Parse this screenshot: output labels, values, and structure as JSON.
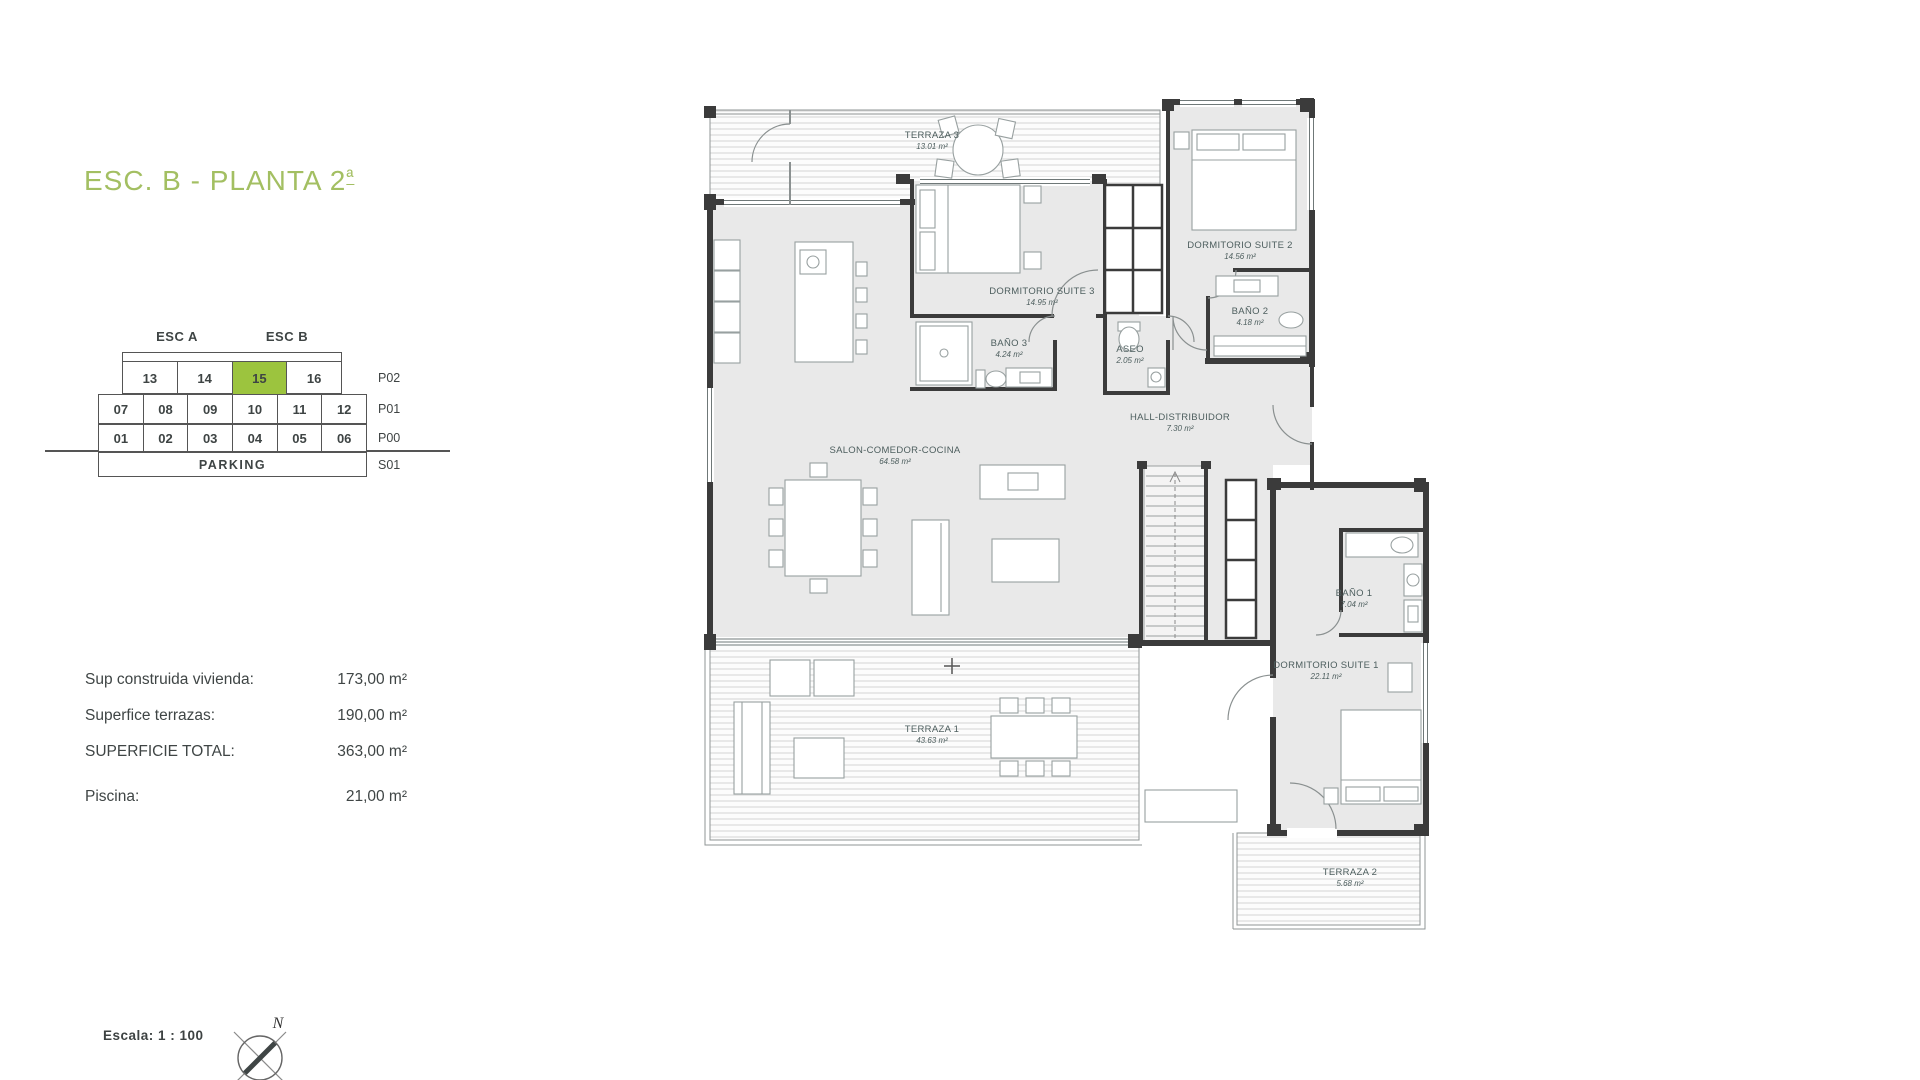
{
  "page": {
    "title": "ESC. B - PLANTA 2",
    "title_ordinal": "ª",
    "scale_label": "Escala:  1 : 100",
    "north_label": "N"
  },
  "unit_grid": {
    "headers": {
      "esc_a": "ESC A",
      "esc_b": "ESC B"
    },
    "floor_labels": [
      "P02",
      "P01",
      "P00",
      "S01"
    ],
    "rows": {
      "p02": [
        "13",
        "14",
        "15",
        "16"
      ],
      "p01": [
        "07",
        "08",
        "09",
        "10",
        "11",
        "12"
      ],
      "p00": [
        "01",
        "02",
        "03",
        "04",
        "05",
        "06"
      ],
      "s01": [
        "PARKING"
      ]
    },
    "highlighted_unit": "15",
    "highlight_color": "#9cc43e"
  },
  "surfaces": [
    {
      "label": "Sup construida vivienda:",
      "value": "173,00 m²"
    },
    {
      "label": "Superfice terrazas:",
      "value": "190,00 m²"
    },
    {
      "label": "SUPERFICIE TOTAL:",
      "value": "363,00 m²"
    },
    {
      "label": "Piscina:",
      "value": "21,00 m²"
    }
  ],
  "floorplan": {
    "rooms": [
      {
        "name": "TERRAZA 3",
        "area": "13.01 m²"
      },
      {
        "name": "DORMITORIO SUITE 3",
        "area": "14.95 m²"
      },
      {
        "name": "DORMITORIO SUITE 2",
        "area": "14.56 m²"
      },
      {
        "name": "BAÑO 3",
        "area": "4.24 m²"
      },
      {
        "name": "BAÑO 2",
        "area": "4.18 m²"
      },
      {
        "name": "ASEO",
        "area": "2.05 m²"
      },
      {
        "name": "HALL-DISTRIBUIDOR",
        "area": "7.30 m²"
      },
      {
        "name": "SALON-COMEDOR-COCINA",
        "area": "64.58 m²"
      },
      {
        "name": "BAÑO 1",
        "area": "7.04 m²"
      },
      {
        "name": "DORMITORIO SUITE 1",
        "area": "22.11 m²"
      },
      {
        "name": "TERRAZA 1",
        "area": "43.63 m²"
      },
      {
        "name": "TERRAZA 2",
        "area": "5.68 m²"
      }
    ]
  }
}
